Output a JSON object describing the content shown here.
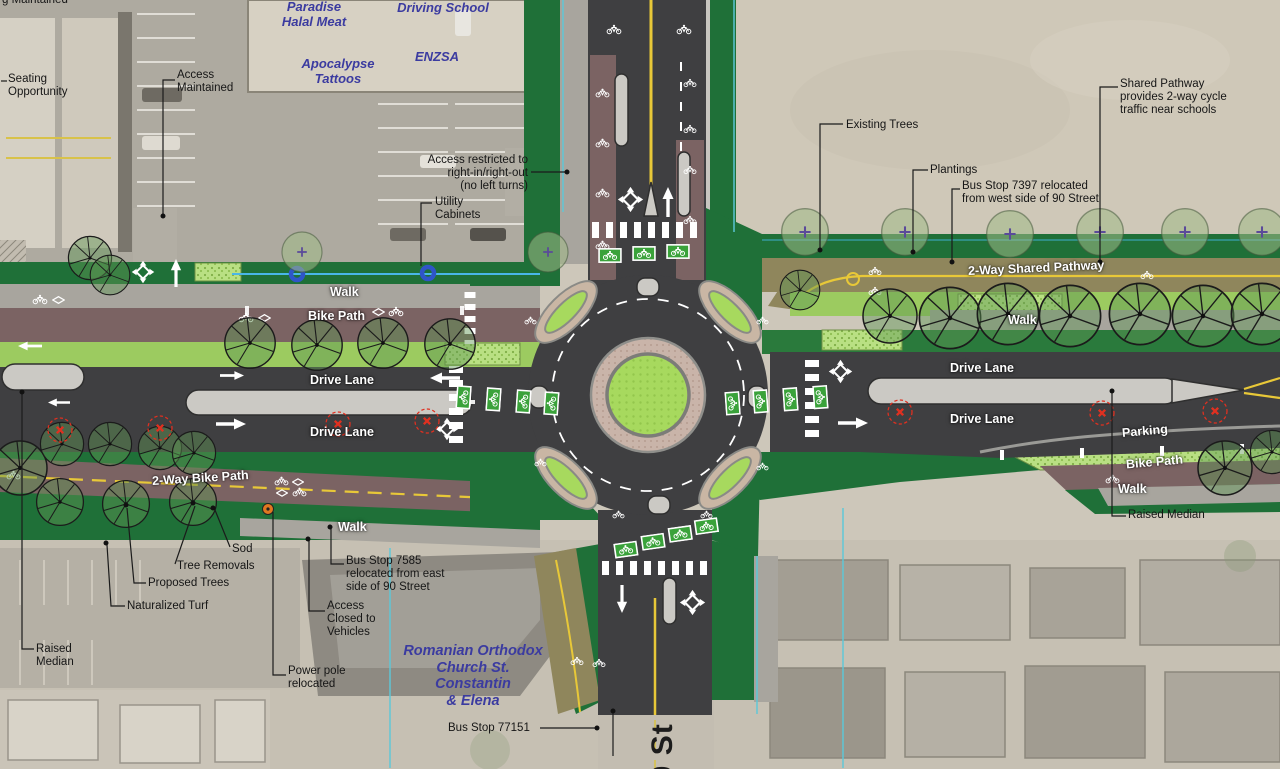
{
  "street": {
    "name": "90 St"
  },
  "businesses": {
    "paradise": "Paradise\nHalal Meat",
    "driving_school": "Driving School",
    "apocalypse": "Apocalypse\nTattoos",
    "enzsa": "ENZSA",
    "church": "Romanian Orthodox\nChurch St. Constantin\n& Elena"
  },
  "annotations": {
    "maintained_cut": "g Maintained",
    "seating": "Seating\nOpportunity",
    "access_maintained": "Access\nMaintained",
    "access_restricted": "Access restricted to\nright-in/right-out\n(no left turns)",
    "utility_cabinets": "Utility\nCabinets",
    "existing_trees": "Existing Trees",
    "plantings": "Plantings",
    "bus_stop_7397": "Bus Stop 7397 relocated\nfrom west side of 90 Street",
    "shared_pathway_note": "Shared Pathway\nprovides 2-way cycle\ntraffic near schools",
    "sod": "Sod",
    "tree_removals": "Tree Removals",
    "proposed_trees": "Proposed Trees",
    "naturalized_turf": "Naturalized Turf",
    "raised_median_w": "Raised\nMedian",
    "access_closed": "Access\nClosed to\nVehicles",
    "bus_stop_7585": "Bus Stop 7585\nrelocated from east\nside of 90 Street",
    "power_pole": "Power pole\nrelocated",
    "bus_stop_77151": "Bus Stop 77151",
    "raised_median_e": "Raised Median"
  },
  "road_labels": {
    "walk_nw": "Walk",
    "bike_path_w": "Bike Path",
    "drive_lane_w1": "Drive Lane",
    "drive_lane_w2": "Drive Lane",
    "two_way_bike_path": "2-Way Bike Path",
    "walk_sw": "Walk",
    "two_way_shared_pathway": "2-Way Shared Pathway",
    "walk_ne": "Walk",
    "drive_lane_e1": "Drive Lane",
    "drive_lane_e2": "Drive Lane",
    "parking": "Parking",
    "bike_path_e": "Bike Path",
    "walk_se": "Walk"
  },
  "icons": {
    "roundabout_symbol": "diamond-with-four-arrows",
    "bike_lane_marker": "white-bicycle",
    "lane_arrow": "white-arrow",
    "bike_crossing_box": "green-box-white-bicycle",
    "tree_removal_marker": "red-dashed-circle-x",
    "proposed_tree_marker": "circle-with-branch-spokes",
    "existing_tree_marker": "soft-canopy-purple-cross",
    "power_pole_marker": "orange-dot",
    "utility_marker": "blue-ring"
  },
  "colors": {
    "asphalt": "#3f3f41",
    "bike_path_brown": "#7b6363",
    "shared_pathway_olive": "#8f865c",
    "sod_green": "#1f7038",
    "lawn_green": "#9ccb60",
    "island_green": "#a7d95e",
    "truck_apron": "#c9b4a9",
    "bike_box_green": "#3aa23a",
    "walk_gray": "#a8a59e",
    "median_gray": "#cbc9c4",
    "aerial_tan": "#cdc7ba",
    "centerline_yellow": "#e8c838",
    "boundary_cyan": "#5cc8d8",
    "utility_blue": "#2f55c8",
    "removal_red": "#e03020",
    "power_pole_orange": "#e07820"
  }
}
